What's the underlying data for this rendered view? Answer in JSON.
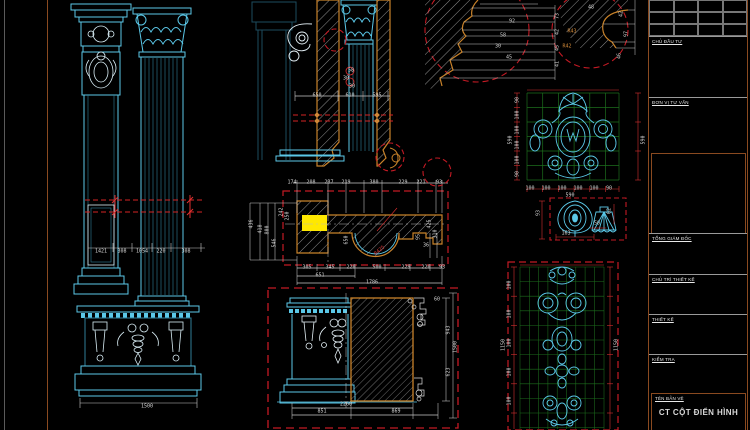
{
  "page": {
    "width": 750,
    "height": 430,
    "background": "#000000"
  },
  "colors": {
    "cyan_line": "#5bc8e8",
    "cyan_dim": "#2f7e98",
    "white_line": "#dcdcdc",
    "red_dim": "#d42424",
    "red_dashed": "#c41a24",
    "orange_section": "#c8822a",
    "orange_frame": "#8a4a20",
    "yellow_highlight": "#ffe800",
    "green_grid": "#1d6e1d"
  },
  "title_block": {
    "client_label": "CHỦ ĐẦU TƯ",
    "consultant_label": "ĐƠN VỊ TƯ VẤN",
    "director_label": "TỔNG GIÁM ĐỐC",
    "lead_designer_label": "CHỦ TRÌ THIẾT KẾ",
    "designer_label": "THIẾT KẾ",
    "checker_label": "KIỂM TRA",
    "drawing_name_label": "TÊN BẢN VẼ",
    "drawing_title": "CT CỘT ĐIỂN HÌNH"
  },
  "annotations": [
    {
      "x": 101,
      "y": 252,
      "t": "1421"
    },
    {
      "x": 122,
      "y": 252,
      "t": "308"
    },
    {
      "x": 142,
      "y": 252,
      "t": "1054"
    },
    {
      "x": 161,
      "y": 252,
      "t": "220"
    },
    {
      "x": 186,
      "y": 252,
      "t": "308"
    },
    {
      "x": 147,
      "y": 407,
      "t": "1500"
    },
    {
      "x": 317,
      "y": 96,
      "t": "650"
    },
    {
      "x": 350,
      "y": 96,
      "t": "610"
    },
    {
      "x": 377,
      "y": 96,
      "t": "595"
    },
    {
      "x": 351,
      "y": 71,
      "t": "58"
    },
    {
      "x": 346,
      "y": 79,
      "t": "30"
    },
    {
      "x": 352,
      "y": 87,
      "t": "30"
    },
    {
      "x": 512,
      "y": 22,
      "t": "92"
    },
    {
      "x": 503,
      "y": 36,
      "t": "58"
    },
    {
      "x": 498,
      "y": 47,
      "t": "30"
    },
    {
      "x": 509,
      "y": 58,
      "t": "45"
    },
    {
      "x": 558,
      "y": 16,
      "t": "73",
      "r": -90
    },
    {
      "x": 558,
      "y": 32,
      "t": "42",
      "r": -90
    },
    {
      "x": 558,
      "y": 48,
      "t": "45",
      "r": -90
    },
    {
      "x": 558,
      "y": 64,
      "t": "41",
      "r": -90
    },
    {
      "x": 591,
      "y": 8,
      "t": "48"
    },
    {
      "x": 622,
      "y": 14,
      "t": "42",
      "r": -90
    },
    {
      "x": 627,
      "y": 34,
      "t": "97",
      "r": -90
    },
    {
      "x": 620,
      "y": 56,
      "t": "46",
      "r": -90
    },
    {
      "x": 572,
      "y": 32,
      "t": "R43",
      "c": "o"
    },
    {
      "x": 567,
      "y": 47,
      "t": "R42",
      "c": "o"
    },
    {
      "x": 292,
      "y": 183,
      "t": "174"
    },
    {
      "x": 311,
      "y": 183,
      "t": "208"
    },
    {
      "x": 329,
      "y": 183,
      "t": "237"
    },
    {
      "x": 346,
      "y": 183,
      "t": "219"
    },
    {
      "x": 374,
      "y": 183,
      "t": "380"
    },
    {
      "x": 403,
      "y": 183,
      "t": "229"
    },
    {
      "x": 421,
      "y": 183,
      "t": "221"
    },
    {
      "x": 439,
      "y": 183,
      "t": "93"
    },
    {
      "x": 307,
      "y": 268,
      "t": "305"
    },
    {
      "x": 330,
      "y": 268,
      "t": "345"
    },
    {
      "x": 351,
      "y": 268,
      "t": "220"
    },
    {
      "x": 377,
      "y": 268,
      "t": "500"
    },
    {
      "x": 406,
      "y": 268,
      "t": "229"
    },
    {
      "x": 426,
      "y": 268,
      "t": "220"
    },
    {
      "x": 442,
      "y": 268,
      "t": "93"
    },
    {
      "x": 320,
      "y": 276,
      "t": "651"
    },
    {
      "x": 372,
      "y": 283,
      "t": "1786"
    },
    {
      "x": 252,
      "y": 224,
      "t": "436",
      "r": -90
    },
    {
      "x": 261,
      "y": 229,
      "t": "418",
      "r": -90
    },
    {
      "x": 268,
      "y": 230,
      "t": "800",
      "r": -90
    },
    {
      "x": 275,
      "y": 243,
      "t": "546",
      "r": -90
    },
    {
      "x": 282,
      "y": 212,
      "t": "242",
      "r": -90
    },
    {
      "x": 288,
      "y": 216,
      "t": "250",
      "r": -90
    },
    {
      "x": 347,
      "y": 240,
      "t": "650",
      "r": -90
    },
    {
      "x": 380,
      "y": 251,
      "t": "R425",
      "c": "r",
      "r": -40
    },
    {
      "x": 430,
      "y": 224,
      "t": "425",
      "r": -90
    },
    {
      "x": 436,
      "y": 234,
      "t": "310",
      "r": -90
    },
    {
      "x": 419,
      "y": 237,
      "t": "95",
      "r": -90
    },
    {
      "x": 426,
      "y": 246,
      "t": "36"
    },
    {
      "x": 322,
      "y": 412,
      "t": "851"
    },
    {
      "x": 396,
      "y": 412,
      "t": "869"
    },
    {
      "x": 346,
      "y": 405,
      "t": "2260"
    },
    {
      "x": 449,
      "y": 330,
      "t": "943",
      "r": -90
    },
    {
      "x": 449,
      "y": 372,
      "t": "623",
      "r": -90
    },
    {
      "x": 456,
      "y": 347,
      "t": "1500",
      "r": -90
    },
    {
      "x": 437,
      "y": 300,
      "t": "60"
    },
    {
      "x": 511,
      "y": 140,
      "t": "590",
      "r": -90
    },
    {
      "x": 644,
      "y": 140,
      "t": "590",
      "r": -90
    },
    {
      "x": 570,
      "y": 196,
      "t": "590"
    },
    {
      "x": 530,
      "y": 189,
      "t": "100"
    },
    {
      "x": 546,
      "y": 189,
      "t": "100"
    },
    {
      "x": 562,
      "y": 189,
      "t": "100"
    },
    {
      "x": 578,
      "y": 189,
      "t": "100"
    },
    {
      "x": 594,
      "y": 189,
      "t": "100"
    },
    {
      "x": 609,
      "y": 189,
      "t": "90"
    },
    {
      "x": 518,
      "y": 100,
      "t": "90",
      "r": -90
    },
    {
      "x": 518,
      "y": 115,
      "t": "100",
      "r": -90
    },
    {
      "x": 518,
      "y": 130,
      "t": "100",
      "r": -90
    },
    {
      "x": 518,
      "y": 145,
      "t": "100",
      "r": -90
    },
    {
      "x": 518,
      "y": 160,
      "t": "100",
      "r": -90
    },
    {
      "x": 518,
      "y": 174,
      "t": "90",
      "r": -90
    },
    {
      "x": 539,
      "y": 213,
      "t": "93",
      "r": -90
    },
    {
      "x": 566,
      "y": 234,
      "t": "163"
    },
    {
      "x": 597,
      "y": 224,
      "t": "50"
    },
    {
      "x": 610,
      "y": 211,
      "t": "62",
      "r": -90
    },
    {
      "x": 504,
      "y": 345,
      "t": "1150",
      "r": -90
    },
    {
      "x": 617,
      "y": 345,
      "t": "1150",
      "r": -90
    },
    {
      "x": 510,
      "y": 285,
      "t": "100",
      "r": -90
    },
    {
      "x": 510,
      "y": 314,
      "t": "100",
      "r": -90
    },
    {
      "x": 510,
      "y": 343,
      "t": "100",
      "r": -90
    },
    {
      "x": 510,
      "y": 372,
      "t": "100",
      "r": -90
    },
    {
      "x": 510,
      "y": 401,
      "t": "100",
      "r": -90
    }
  ]
}
